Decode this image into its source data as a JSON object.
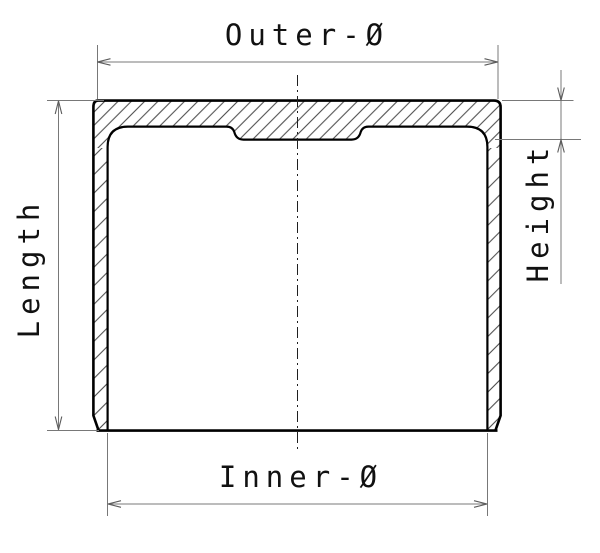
{
  "drawing": {
    "type": "technical-cross-section",
    "view": "sectioned cylindrical cup with hatched walls, vertical dash-dot centerline and four dimension callouts",
    "dimensions": [
      {
        "id": "outer-diameter",
        "label": "Outer-Ø",
        "orientation": "horizontal",
        "position": "top"
      },
      {
        "id": "length",
        "label": "Length",
        "orientation": "vertical",
        "position": "left"
      },
      {
        "id": "height",
        "label": "Height",
        "orientation": "vertical",
        "position": "right"
      },
      {
        "id": "inner-diameter",
        "label": "Inner-Ø",
        "orientation": "horizontal",
        "position": "bottom"
      }
    ],
    "colors": {
      "background": "#ffffff",
      "outline": "#000000",
      "hatch": "#2b2b2b",
      "dimension_lines": "#787878",
      "arrowheads": "#5a5a5a",
      "centerline": "#1f1f1f",
      "text": "#111111"
    }
  }
}
